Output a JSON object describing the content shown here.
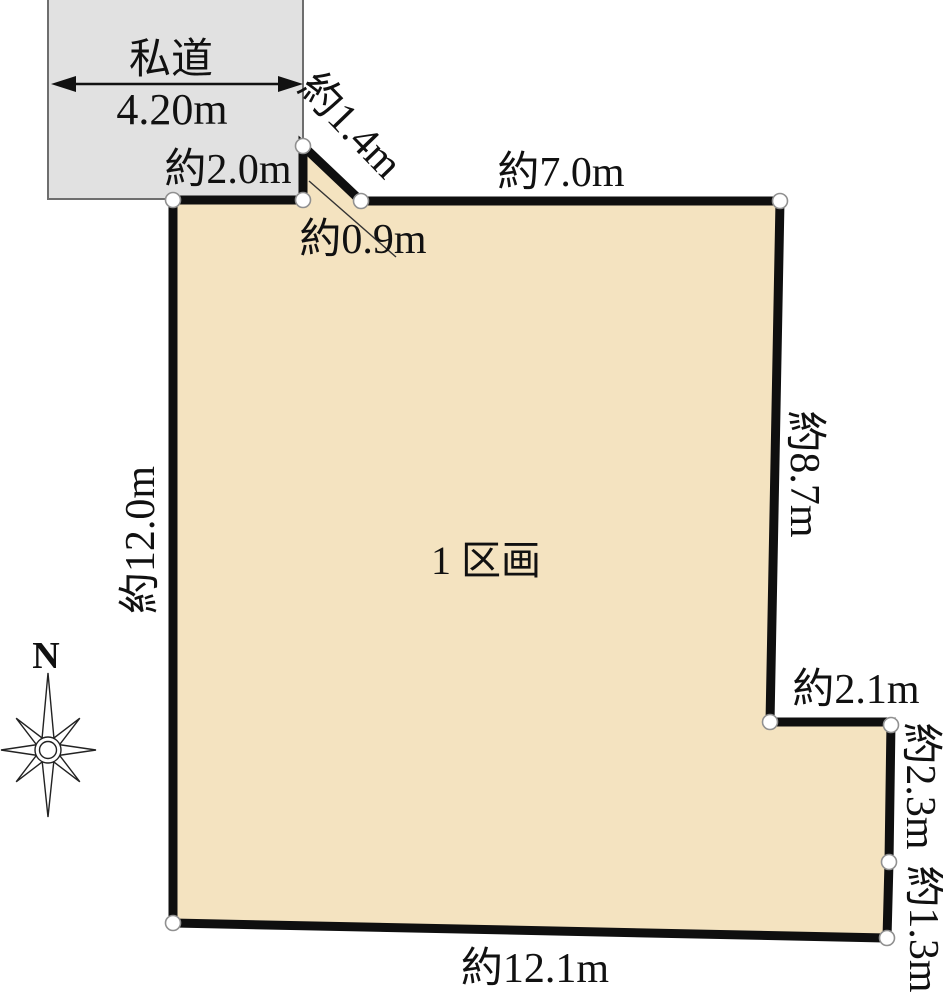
{
  "diagram": {
    "title_hint": "land lot plan",
    "road": {
      "label": "私道",
      "width_label": "4.20m"
    },
    "lot": {
      "label": "1 区画"
    },
    "dimensions": {
      "top_left": "約2.0m",
      "notch_diagonal": "約1.4m",
      "top": "約7.0m",
      "notch_opening": "約0.9m",
      "left": "約12.0m",
      "right": "約8.7m",
      "step_top": "約2.1m",
      "step_right_upper": "約2.3m",
      "step_right_lower": "約1.3m",
      "bottom": "約12.1m"
    },
    "compass": {
      "north_label": "N"
    },
    "colors": {
      "lot_fill": "#f4e3c0",
      "road_fill": "#e1e1e1",
      "outline": "#111111",
      "road_border": "#6e6e6e"
    }
  }
}
